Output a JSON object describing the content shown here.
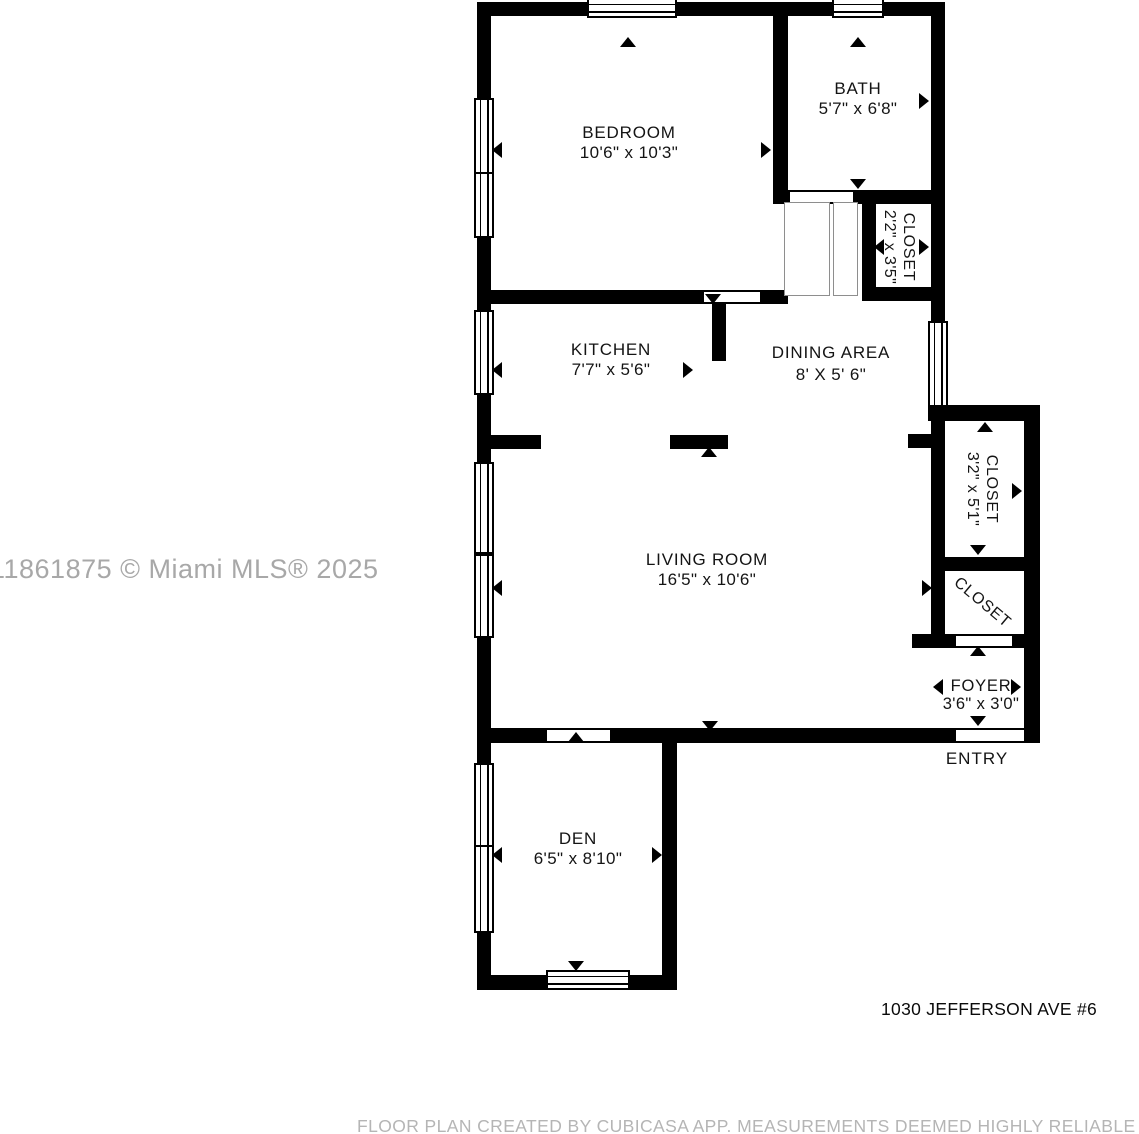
{
  "watermark": "11861875 © Miami MLS® 2025",
  "address": "1030 JEFFERSON AVE #6",
  "footer": "FLOOR PLAN CREATED BY CUBICASA APP. MEASUREMENTS DEEMED HIGHLY RELIABLE BUT NOT GUARANTEED",
  "entry": "ENTRY",
  "rooms": {
    "bedroom": {
      "name": "BEDROOM",
      "dims": "10'6\" x 10'3\""
    },
    "bath": {
      "name": "BATH",
      "dims": "5'7\" x 6'8\""
    },
    "closet_hall": {
      "name": "CLOSET",
      "dims": "2'2\" x 3'5\""
    },
    "kitchen": {
      "name": "KITCHEN",
      "dims": "7'7\" x 5'6\""
    },
    "dining": {
      "name": "DINING AREA",
      "dims": "8' X 5' 6\""
    },
    "closet_tall": {
      "name": "CLOSET",
      "dims": "3'2\" x 5'1\""
    },
    "closet_small": {
      "name": "CLOSET"
    },
    "living": {
      "name": "LIVING ROOM",
      "dims": "16'5\" x 10'6\""
    },
    "foyer": {
      "name": "FOYER",
      "dims": "3'6\" x 3'0\""
    },
    "den": {
      "name": "DEN",
      "dims": "6'5\" x 8'10\""
    }
  },
  "colors": {
    "wall": "#000000",
    "label": "#141414",
    "watermark": "#a8a8a8",
    "footer": "#b5b5b5"
  }
}
